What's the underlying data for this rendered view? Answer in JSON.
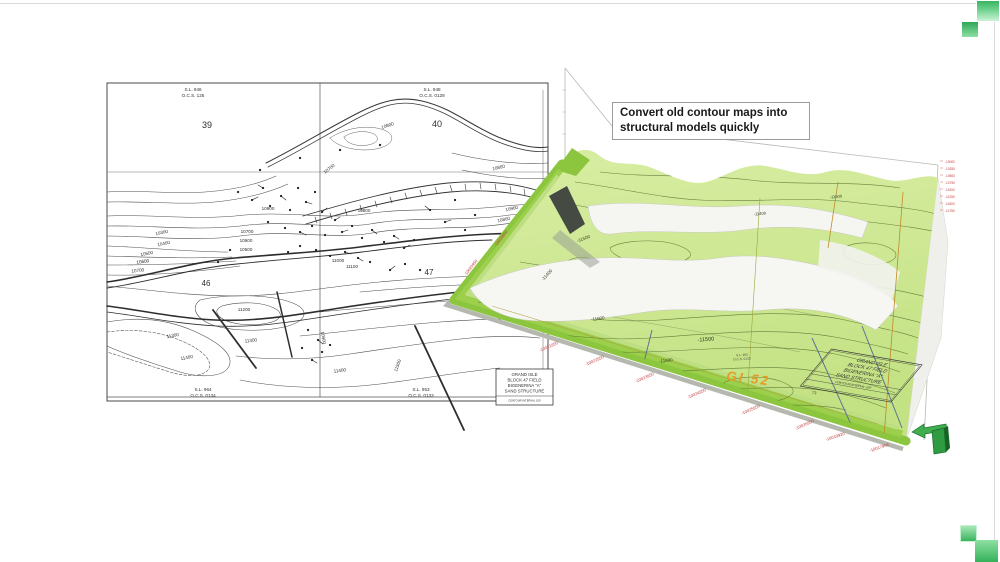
{
  "slide": {
    "background": "#ffffff",
    "border_color": "#dadada",
    "accent_green_dark": "#2ea855",
    "accent_green_light": "#cdf2d8"
  },
  "callout": {
    "line1": "Convert old contour maps into",
    "line2": "structural models quickly"
  },
  "map2d": {
    "survey_labels": [
      {
        "line1": "S.L. 946",
        "line2": "O.C.S. 125"
      },
      {
        "line1": "S.L. 948",
        "line2": "O.C.S. 0128"
      },
      {
        "line1": "S.L. 964",
        "line2": "O.C.S. 0134"
      },
      {
        "line1": "S.L. 953",
        "line2": "O.C.S. 0133"
      }
    ],
    "block_numbers": [
      "39",
      "40",
      "46",
      "47"
    ],
    "contour_labels": [
      "10300",
      "10400",
      "10500",
      "10600",
      "10700",
      "10700",
      "10800",
      "10900",
      "10800",
      "10600",
      "10500",
      "10700",
      "11000",
      "10900",
      "11200",
      "11300",
      "11400",
      "11300",
      "11400",
      "11500",
      "10900",
      "10800",
      "11100",
      "10800"
    ],
    "title_block": {
      "l1": "GRAND ISLE",
      "l2": "BLOCK 47 FIELD",
      "l3": "BIGENERINA \"A\"",
      "l4": "SAND STRUCTURE",
      "sub": "CONTOUR INTERVAL 100'"
    }
  },
  "model3d": {
    "surface_green": "#cfe79b",
    "edge_lime": "#8cc63e",
    "contour_ink": "#5c7531",
    "field_label": "GI 52",
    "field_label_color": "#e49b26",
    "depth_labels": [
      "-11400",
      "-11500",
      "-11600",
      "-11500",
      "-11600",
      "-11500",
      "-11400"
    ],
    "coord_labels_bottom": [
      "-10021950",
      "-10022950",
      "-10023950",
      "-10024950",
      "-10025950",
      "-10026950",
      "-10019920",
      "-10017956"
    ],
    "coord_labels_left": [
      "-10020950",
      "-10019950"
    ],
    "axis_ticks_right": [
      "-10000",
      "-10250",
      "-10500",
      "-10750",
      "-11000",
      "-11250",
      "-11500",
      "-11750"
    ],
    "surface_survey": {
      "l1": "S.L. 953",
      "l2": "O.C.S. 0133"
    },
    "well_number": "73",
    "title_block": {
      "l1": "GRAND ISLE",
      "l2": "BLOCK 47 FIELD",
      "l3": "BIGENERINA \"A\"",
      "l4": "SAND STRUCTURE",
      "sub": "CONTOUR INTERVAL 100'"
    }
  }
}
